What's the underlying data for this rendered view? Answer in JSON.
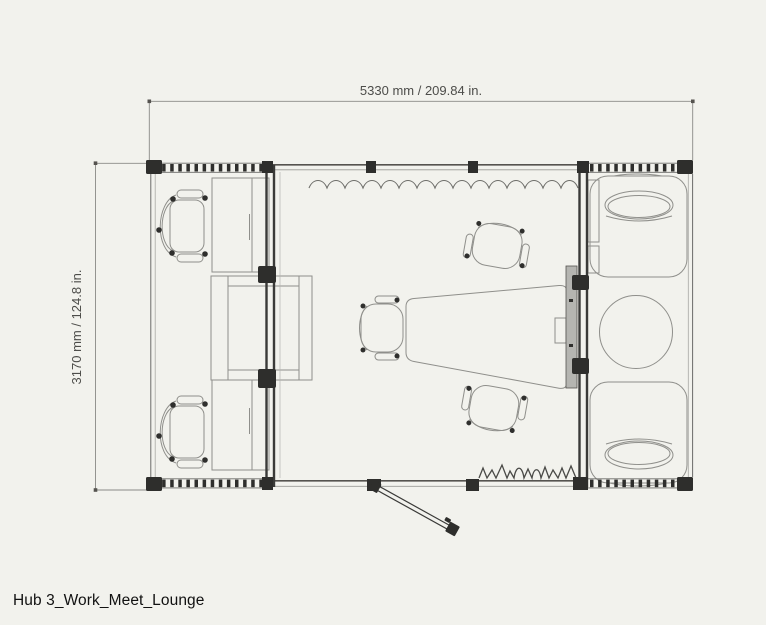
{
  "title": "Hub 3_Work_Meet_Lounge",
  "dimensions": {
    "width_label": "5330 mm / 209.84 in.",
    "height_label": "3170 mm / 124.8 in."
  },
  "colors": {
    "background": "#f2f2ed",
    "wall_dark": "#2e2e2c",
    "line_medium": "#6b6b68",
    "furniture_line": "#8f8f8b",
    "dimension_text": "#4d4d4a",
    "title_text": "#111111",
    "screen_fill": "#b5b5b1"
  }
}
